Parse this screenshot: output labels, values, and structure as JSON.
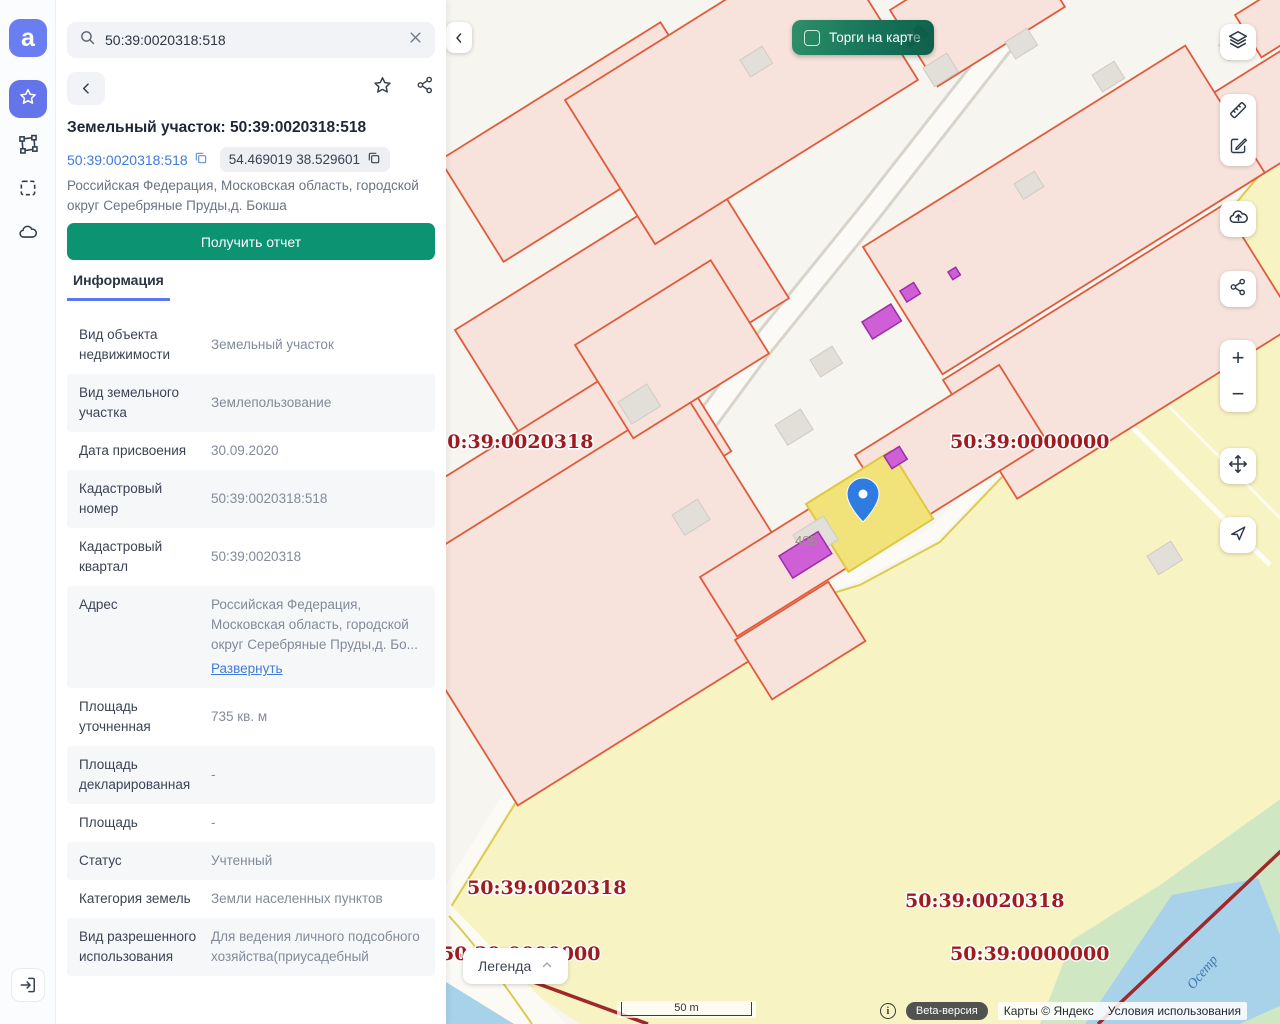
{
  "colors": {
    "accent_blue": "#6474ea",
    "link_blue": "#3e7bdb",
    "report_green": "#0c9371",
    "trades_green": "#17745a",
    "parcel_pink": "#f8e3dc",
    "parcel_stroke": "#e05b3b",
    "quarter_yellow": "#f8f3c2",
    "selected_yellow": "#f1e379",
    "quarter_label_red": "#9e1b20",
    "magenta_building": "#cf5fd6"
  },
  "rail": {
    "logo": "a",
    "items": [
      {
        "name": "favorites",
        "icon": "star-icon",
        "active": true
      },
      {
        "name": "polygon-tool",
        "icon": "polygon-icon",
        "active": false
      },
      {
        "name": "area-select",
        "icon": "dashed-square-icon",
        "active": false
      },
      {
        "name": "cloud",
        "icon": "cloud-icon",
        "active": false
      }
    ],
    "exit_icon": "sign-in-icon"
  },
  "panel": {
    "search": {
      "value": "50:39:0020318:518",
      "clear_icon": "close-icon"
    },
    "title": "Земельный участок: 50:39:0020318:518",
    "cadastral_link": "50:39:0020318:518",
    "coordinates_chip": "54.469019 38.529601",
    "address": "Российская Федерация, Московская область, городской округ Серебряные Пруды,д. Бокша",
    "report_button": "Получить отчет",
    "tab": "Информация",
    "rows": [
      {
        "label": "Вид объекта недвижимости",
        "value": "Земельный участок"
      },
      {
        "label": "Вид земельного участка",
        "value": "Землепользование"
      },
      {
        "label": "Дата присвоения",
        "value": "30.09.2020"
      },
      {
        "label": "Кадастровый номер",
        "value": "50:39:0020318:518"
      },
      {
        "label": "Кадастровый квартал",
        "value": "50:39:0020318"
      },
      {
        "label": "Адрес",
        "value": "Российская Федерация, Московская область, городской округ Серебряные Пруды,д. Бо...",
        "link": "Развернуть"
      },
      {
        "label": "Площадь уточненная",
        "value": "735 кв. м"
      },
      {
        "label": "Площадь декларированная",
        "value": "-"
      },
      {
        "label": "Площадь",
        "value": "-"
      },
      {
        "label": "Статус",
        "value": "Учтенный"
      },
      {
        "label": "Категория земель",
        "value": "Земли населенных пунктов"
      },
      {
        "label": "Вид разрешенного использования",
        "value": "Для ведения личного подсобного хозяйства(приусадебный"
      }
    ]
  },
  "map": {
    "trades_button": "Торги на карте",
    "legend_button": "Легенда",
    "scale_label": "50 m",
    "beta_label": "Beta-версия",
    "attribution": {
      "maps": "Карты © Яндекс",
      "terms": "Условия использования"
    },
    "labels": [
      {
        "text": "50:39:0020318"
      },
      {
        "text": "50:39:0000000"
      },
      {
        "text": "50:39:0020318"
      },
      {
        "text": "50:39:0020318"
      },
      {
        "text": "50:39:0000000"
      },
      {
        "text": "50:39:0000000"
      }
    ],
    "house_label": "40Б",
    "river_label": "Осетр",
    "toolbar": [
      "layers-icon",
      "ruler-icon",
      "edit-icon",
      "cloud-upload-icon",
      "share-icon",
      "zoom-in",
      "zoom-out",
      "pan-icon",
      "locate-icon"
    ]
  }
}
